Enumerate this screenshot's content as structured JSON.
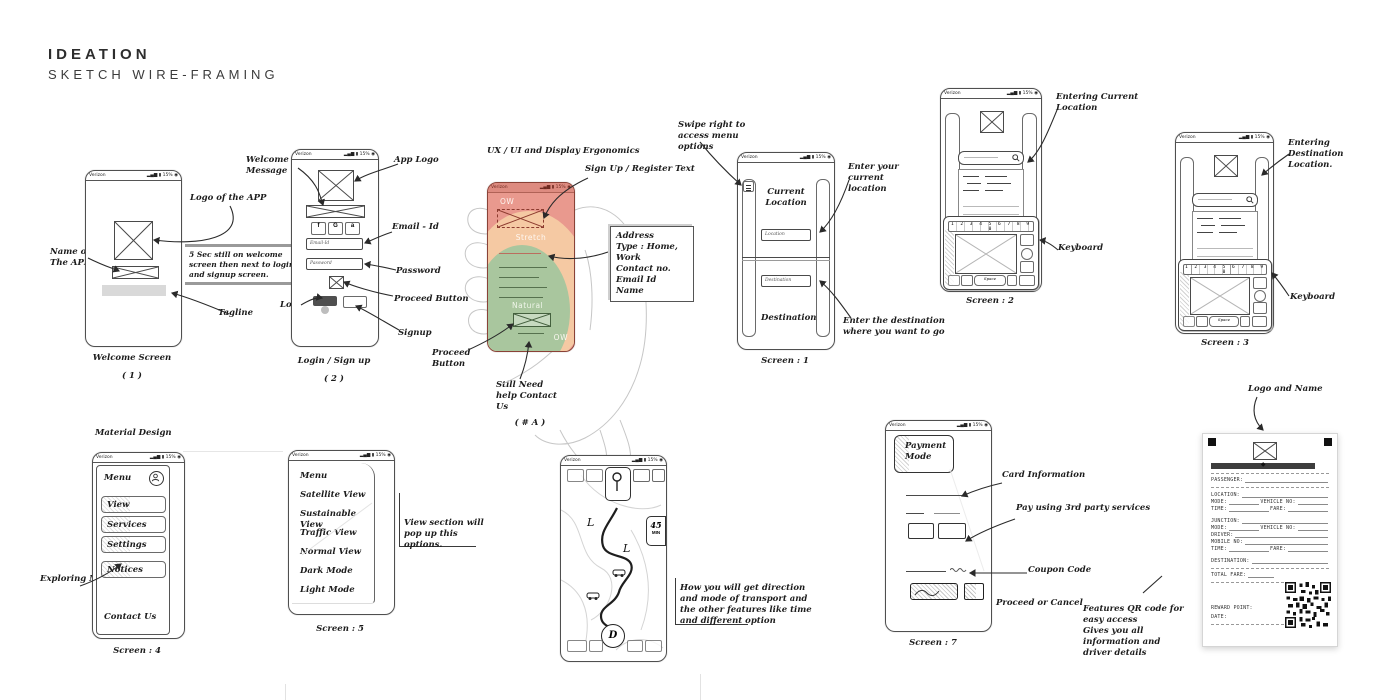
{
  "header": {
    "title": "IDEATION",
    "subtitle": "SKETCH WIRE-FRAMING"
  },
  "status": {
    "carrier": "Verizon",
    "icons": "▂▄▆ ▮ 15% ◉"
  },
  "welcome": {
    "caption": "Welcome Screen",
    "number": "( 1 )",
    "ann_name": "Name of The APP",
    "ann_logo": "Logo of the APP",
    "ann_tagline": "Tagline",
    "note": "5 Sec still on welcome screen then next to login and signup screen."
  },
  "login": {
    "caption": "Login / Sign up",
    "number": "( 2 )",
    "ann_welcome": "Welcome Message",
    "ann_logo": "App Logo",
    "ann_email": "Email - Id",
    "ann_password": "Password",
    "ann_proceed": "Proceed Button",
    "ann_login": "Login",
    "ann_signup": "Signup",
    "social": [
      "f",
      "G",
      "a"
    ],
    "email_placeholder": "Email-Id",
    "password_placeholder": "Password"
  },
  "ergo": {
    "title": "UX / UI and Display Ergonomics",
    "caption": "( # A )",
    "zone_top": "OW",
    "zone_stretch": "Stretch",
    "zone_natural": "Natural",
    "zone_bottom": "OW",
    "ann_signup": "Sign Up / Register Text",
    "address": [
      "Address",
      "Type : Home, Work",
      "Contact no.",
      "Email Id",
      "Name"
    ],
    "ann_proceed": "Proceed Button",
    "ann_help": "Still Need help Contact Us"
  },
  "s1": {
    "caption": "Screen : 1",
    "label_current": "Current Location",
    "label_destination": "Destination",
    "input_location": "Location",
    "input_destination": "Destination",
    "ann_swipe": "Swipe right to access menu options",
    "ann_current": "Enter your current location",
    "ann_destination": "Enter the destination where you want to go"
  },
  "s2": {
    "caption": "Screen : 2",
    "ann_entering": "Entering Current Location",
    "ann_keyboard": "Keyboard",
    "numrow": "1 2 3 4 5 6 7 8 9 0",
    "space_label": "Space"
  },
  "s3": {
    "caption": "Screen : 3",
    "ann_entering": "Entering Destination Location.",
    "ann_keyboard": "Keyboard",
    "numrow": "1 2 3 4 5 6 7 8 9 0",
    "space_label": "Space"
  },
  "s4": {
    "caption": "Screen : 4",
    "title": "Material Design",
    "menu_header": "Menu",
    "items": [
      "View",
      "Services",
      "Settings",
      "Notices"
    ],
    "contact": "Contact Us",
    "ann_explore": "Exploring Menu"
  },
  "s5": {
    "caption": "Screen : 5",
    "items": [
      "Menu",
      "Satellite View",
      "Sustainable View",
      "Traffic View",
      "Normal View",
      "Dark Mode",
      "Light Mode"
    ],
    "ann_view": "View section will pop up this options."
  },
  "map": {
    "badge_time": "45",
    "badge_unit": "MIN",
    "marker": "L",
    "dest": "D",
    "ann": "How you will get direction and mode of transport and the other features like time and different option"
  },
  "s7": {
    "caption": "Screen : 7",
    "title": "Payment Mode",
    "ann_card": "Card Information",
    "ann_pay": "Pay using 3rd party services",
    "ann_coupon": "Coupon Code",
    "ann_proceed": "Proceed  or Cancel"
  },
  "receipt": {
    "ann_logo": "Logo and Name",
    "ann_qr": "Features QR code for easy access",
    "ann_info": "Gives you all information and driver details",
    "fields": {
      "passenger": "PASSENGER:",
      "location": "LOCATION:",
      "mode": "MODE:",
      "vehicle": "VEHICLE NO:",
      "time": "TIME:",
      "fare": "FARE:",
      "junction": "JUNCTION:",
      "driver": "DRIVER:",
      "mobile": "MOBILE NO:",
      "destination": "DESTINATION:",
      "total": "TOTAL FARE:",
      "reward": "REWARD POINT:",
      "date": "DATE:"
    }
  },
  "colors": {
    "salmon": "#e9998e",
    "peach": "#f5c9a3",
    "sage": "#a9c69e"
  }
}
